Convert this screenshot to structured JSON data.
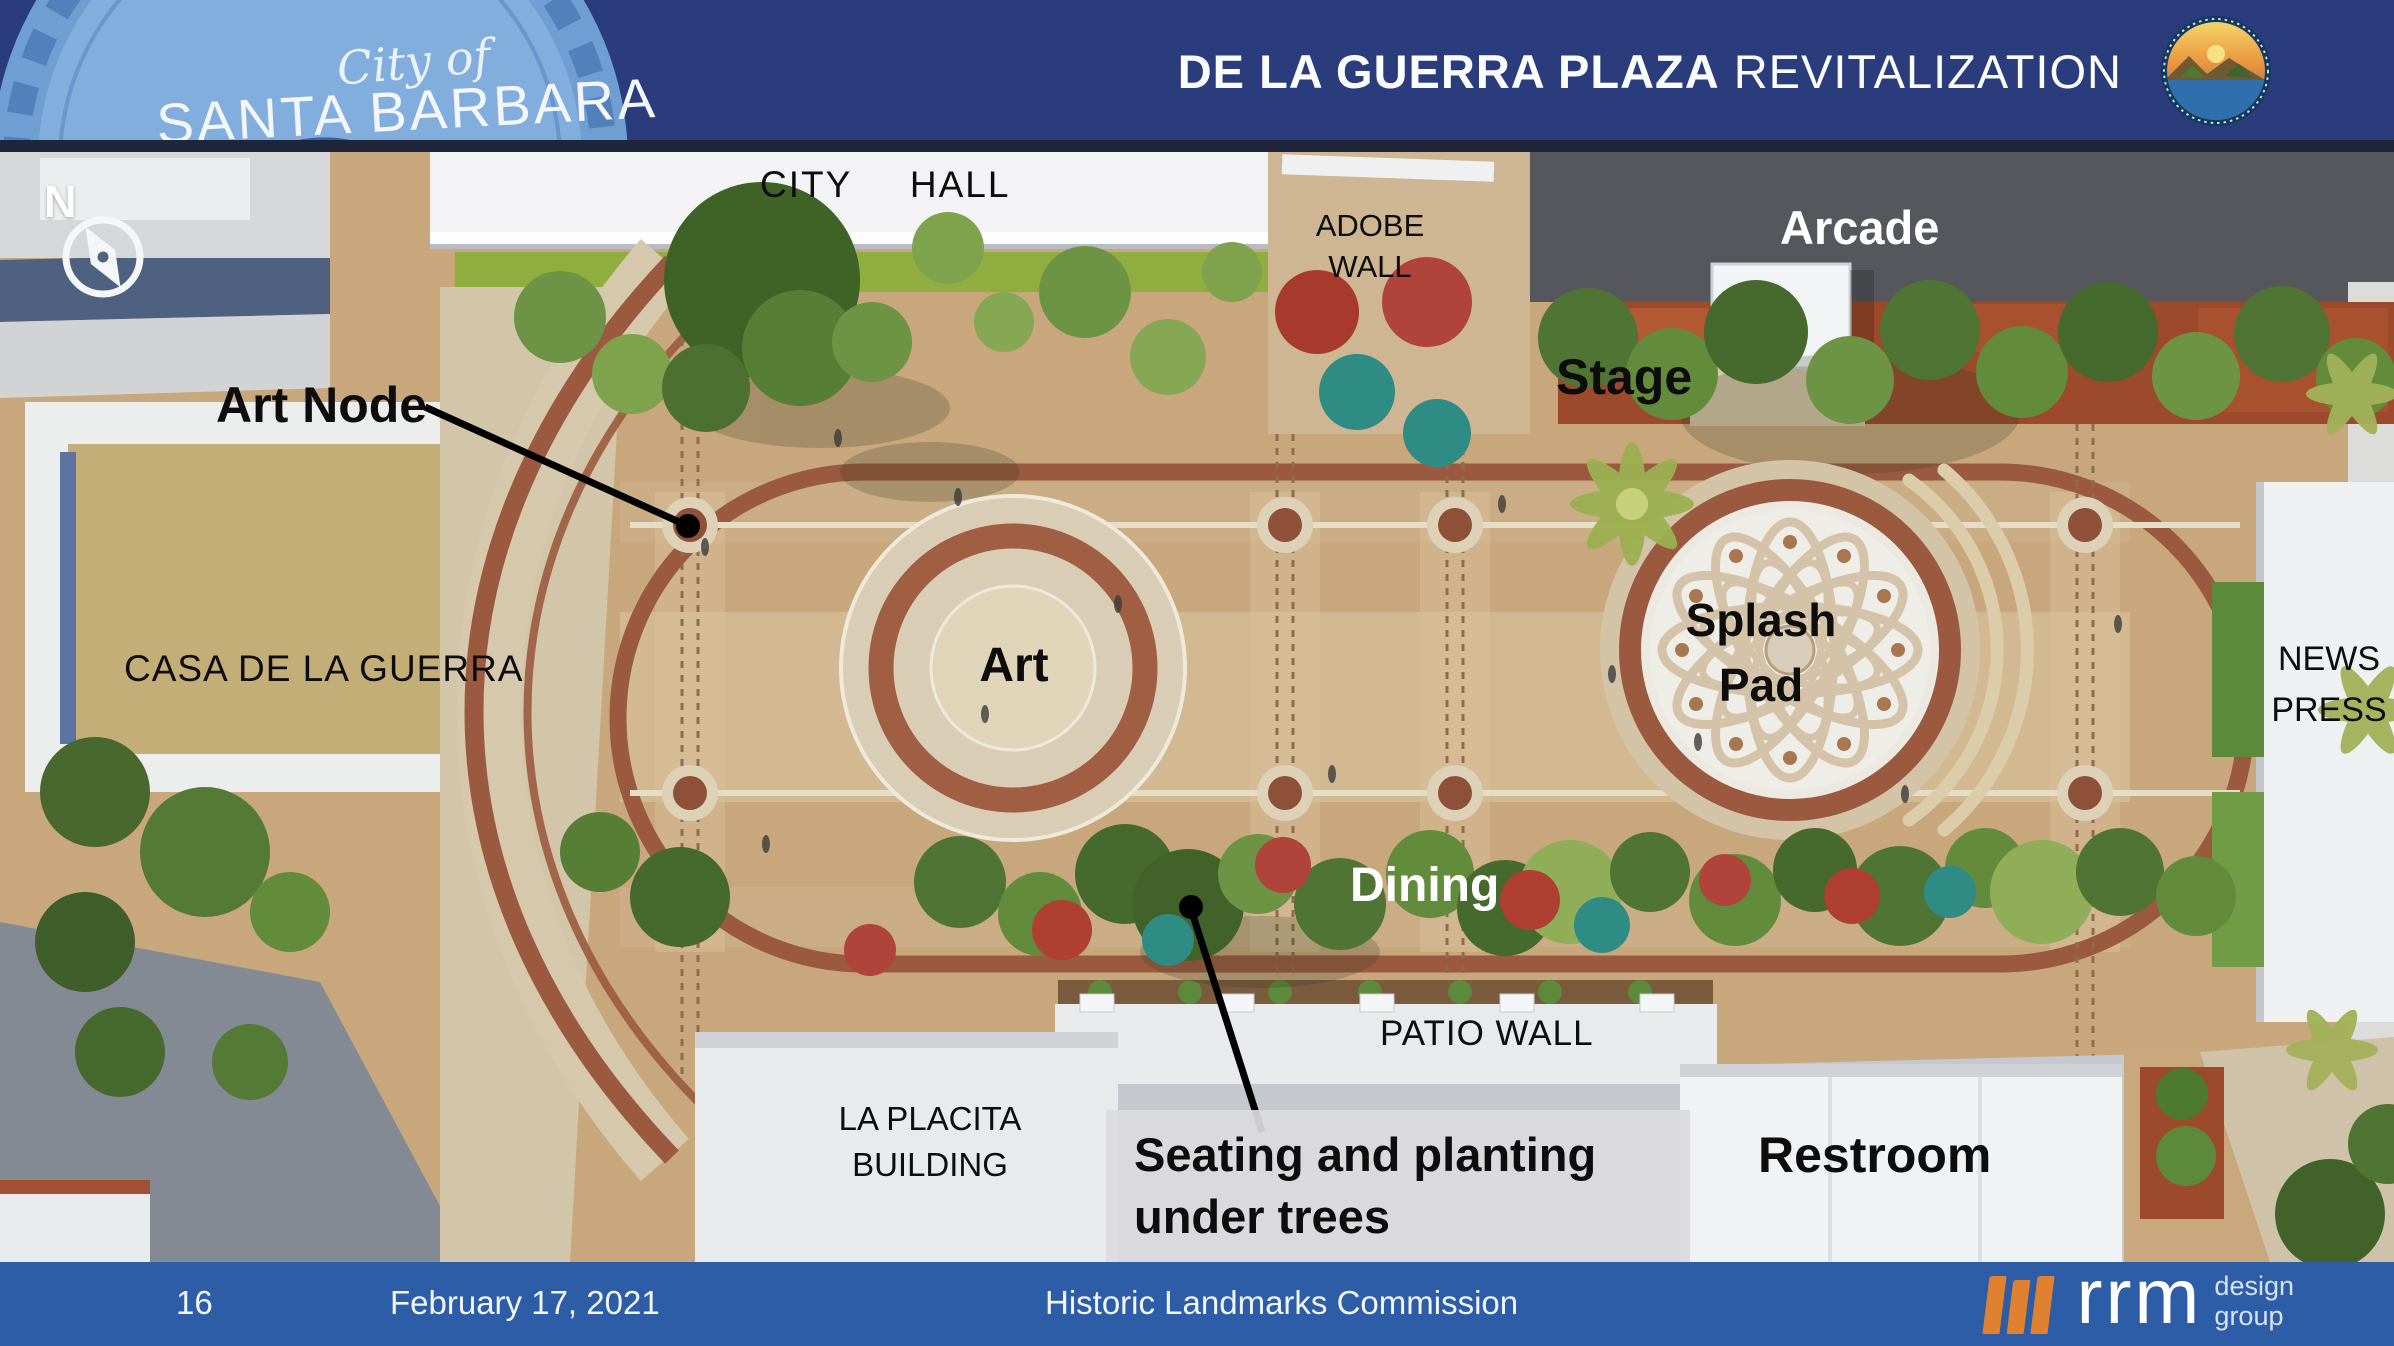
{
  "header": {
    "title_bold": "DE LA GUERRA PLAZA",
    "title_rest": "REVITALIZATION",
    "seal": {
      "script": "City of",
      "name": "SANTA BARBARA"
    }
  },
  "compass": {
    "north": "N"
  },
  "labels": {
    "city_hall": "CITY HALL",
    "adobe_wall": "ADOBE\nWALL",
    "arcade": "Arcade",
    "stage": "Stage",
    "art_node": "Art Node",
    "casa": "CASA DE LA GUERRA",
    "art": "Art",
    "splash_pad": "Splash\nPad",
    "news_press": "NEWS\nPRESS",
    "dining": "Dining",
    "patio_wall": "PATIO WALL",
    "la_placita": "LA PLACITA\nBUILDING",
    "seating": "Seating and planting\nunder trees",
    "restroom": "Restroom"
  },
  "footer": {
    "page": "16",
    "date": "February 17, 2021",
    "title": "Historic Landmarks Commission",
    "logo": {
      "name": "rrm",
      "sub": "design\ngroup"
    }
  },
  "colors": {
    "header_navy": "#2b3c7d",
    "footer_blue": "#2d5da7",
    "logo_orange": "#e0812f",
    "path_brown": "#9b5a3f"
  }
}
